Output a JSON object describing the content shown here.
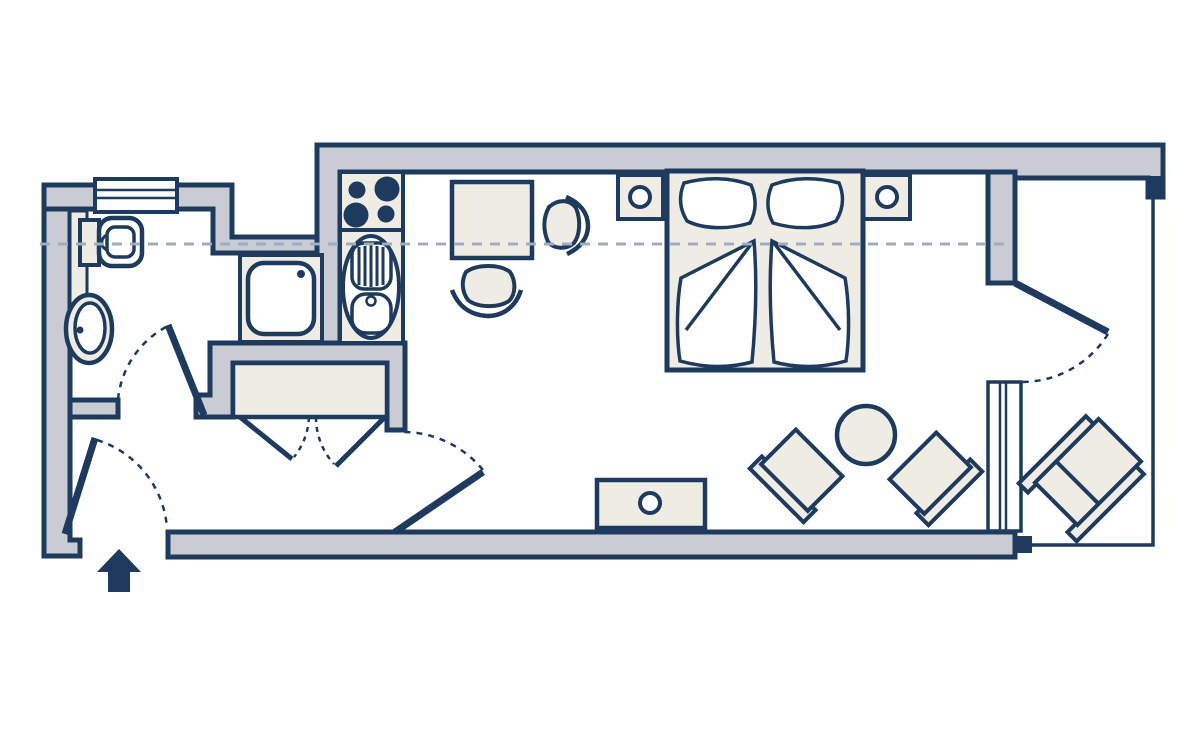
{
  "title": "Studio apartment floor plan",
  "colors": {
    "outline": "#1e3a5e",
    "wall_fill": "#c9ccd3",
    "furniture_fill": "#efece3",
    "background": "#ffffff",
    "section_line": "#9fadc0",
    "white": "#ffffff"
  },
  "rooms": [
    {
      "name": "bathroom",
      "fixtures": [
        "window",
        "wall-mounted-toilet",
        "vanity-shelf",
        "washbasin",
        "shower",
        "door-swing-inward"
      ]
    },
    {
      "name": "entrance-hall",
      "fixtures": [
        "entrance-door",
        "entrance-arrow",
        "wardrobe-with-double-doors"
      ]
    },
    {
      "name": "kitchenette",
      "fixtures": [
        "stove-four-burners",
        "sink-with-drainboard"
      ]
    },
    {
      "name": "living-bedroom",
      "fixtures": [
        "double-bed",
        "pillow-left",
        "pillow-right",
        "duvet-left",
        "duvet-right",
        "nightstand-left-with-lamp",
        "nightstand-right-with-lamp",
        "dining-table",
        "dining-chair-right",
        "dining-chair-bottom",
        "sideboard-with-knob",
        "armchair-left",
        "armchair-right",
        "round-coffee-table",
        "interior-door-swing"
      ]
    },
    {
      "name": "balcony",
      "fixtures": [
        "balcony-door-swing",
        "fixed-glazing-panel",
        "railing",
        "corner-post",
        "lounge-chair"
      ]
    }
  ],
  "annotations": {
    "section_line": "horizontal dashed reference line across plan",
    "door_swings": "dashed quarter-circle arcs",
    "entrance_marker": "solid arrow pointing up at entry door"
  },
  "stove": {
    "burners": 4
  },
  "bed": {
    "pillows": 2,
    "duvets": 2
  }
}
